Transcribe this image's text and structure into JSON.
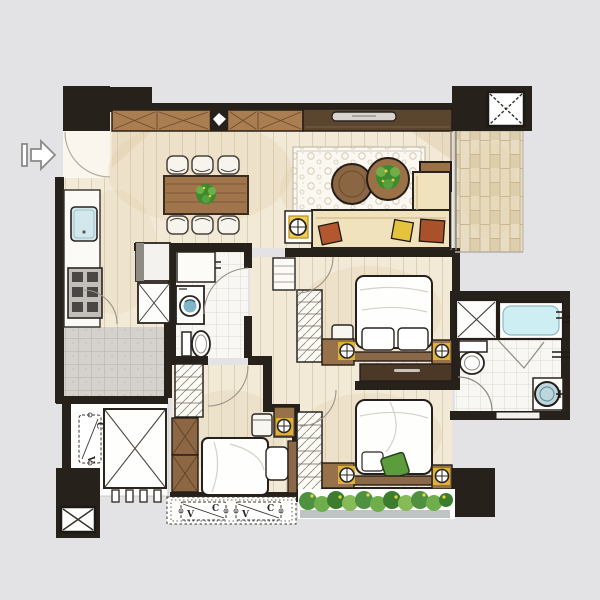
{
  "document": {
    "type": "hand-drawn apartment floor plan, top view",
    "style": "marker and watercolor architectural rendering on light gray background"
  },
  "labels": {
    "ac_units": [
      {
        "id": "ac-unit-horizontal-1",
        "letters": {
          "bottom_left": "V",
          "top_right": "C"
        }
      },
      {
        "id": "ac-unit-horizontal-2",
        "letters": {
          "bottom_left": "V",
          "top_right": "C"
        }
      },
      {
        "id": "ac-unit-vertical",
        "letters": {
          "top": "C",
          "bottom": "V"
        }
      }
    ]
  },
  "icons": [
    "entry-arrow-icon",
    "column-x-marker",
    "shaft-x-box",
    "lamp-crosshair-icon",
    "washing-machine-icon",
    "toilet-icon",
    "bathtub-icon",
    "round-basin-icon",
    "sink-icon",
    "stove-icon",
    "tv-icon",
    "plant-icon"
  ],
  "palette": {
    "background": "#e3e3e5",
    "wall_black": "#27211b",
    "wood_floor": "#f2e9d6",
    "plank_line": "#d9ccb3",
    "cabinet_wood": "#ab7e52",
    "dark_console": "#5a452f",
    "sofa_cream": "#f0e2bd",
    "accent_rust": "#ad552d",
    "accent_yellow": "#e6c33f",
    "accent_gold": "#d4a22b",
    "plant_green": "#4e9140",
    "pillow_green": "#5d9c3c",
    "water_blue": "#cdeef2",
    "tile_white": "#f8f7f3",
    "tile_gray": "#d6d3d0",
    "balcony_tile": "#e9dfc8"
  }
}
